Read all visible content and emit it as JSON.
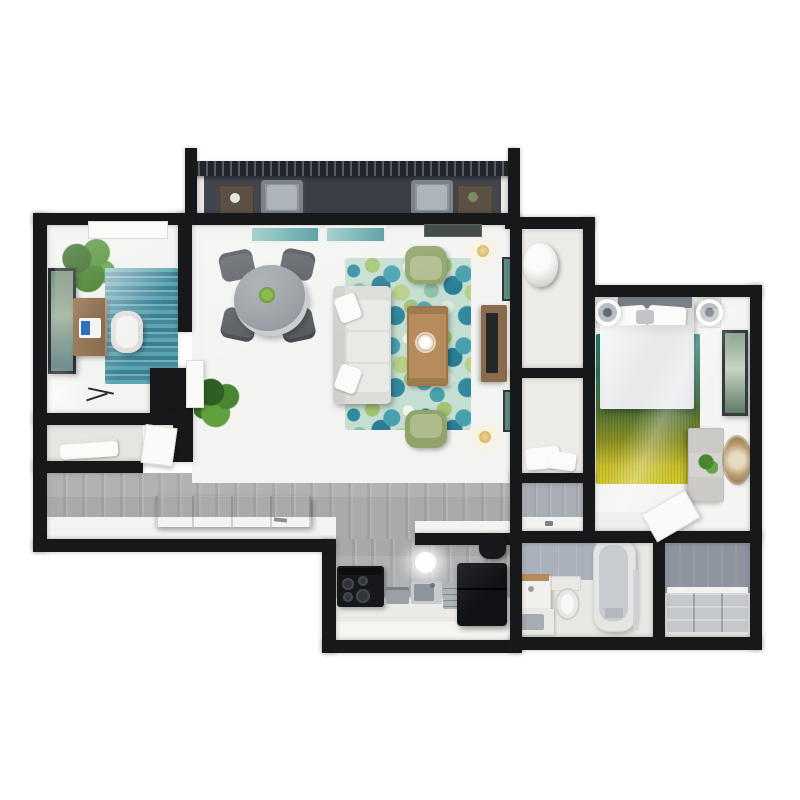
{
  "app": {
    "type": "3d-floor-plan-render",
    "view": "top-down",
    "visible_text": [],
    "background": "#ffffff"
  },
  "colors": {
    "wall": "#17181a",
    "wallface": "#f3f3f1",
    "wood": "#b3b5b7",
    "balcony": "#41464e",
    "balconydark": "#393e47",
    "railing": "#22252a",
    "closetfloor": "#99a1ad",
    "alcove": "#a9aeb4",
    "tile": "#aab1ba",
    "bathfloor": "#e9e7e3",
    "rugofficeB": "#3d7f92",
    "rugliving": "#c5ded2",
    "rugbedtop": "#237f71",
    "rugbedbot": "#d3c92e",
    "sofa": "#dcdcd8",
    "cushion": "#e9e9e5",
    "accentchair": "#90a369",
    "accentseat": "#aebc8b",
    "coffeetable": "#b78c5c",
    "consolewood": "#8a6b4c",
    "deskwood": "#8a6b4c",
    "diningchair": "#54585d",
    "diningtable": "#8f959b",
    "bench": "#c3b194",
    "counter": "#eceae6",
    "appliance": "#17181b",
    "fridge": "#101215",
    "sink": "#8f959c",
    "tubinner": "#c8ccd1",
    "duvet": "#e8e9eb",
    "headboard": "#7b818a",
    "dresser": "#d4d3d0",
    "mirror": "#c3a87e",
    "plantgreen": "#4a8531",
    "windowteal": "#5da3a5",
    "lampgold": "#caa75a"
  },
  "rooms": [
    {
      "id": "balcony",
      "label": "balcony",
      "furniture": [
        "railing",
        "patio-side-table-left",
        "patio-chair-left",
        "patio-chair-right",
        "patio-side-table-right"
      ]
    },
    {
      "id": "office-den",
      "label": "office / den",
      "furniture": [
        "skylight",
        "potted-plant",
        "wall-art",
        "desk",
        "laptop",
        "striped-area-rug",
        "desk-chair",
        "accent-ring-lamp-table"
      ]
    },
    {
      "id": "linen-closet",
      "label": "linen closet",
      "furniture": [
        "folded-linens",
        "open-door"
      ]
    },
    {
      "id": "living-dining",
      "label": "living / dining room",
      "furniture": [
        "window-left",
        "window-right",
        "ceiling-vent",
        "dining-table",
        "dining-chair-nw",
        "dining-chair-ne",
        "dining-chair-sw",
        "dining-chair-se",
        "sofa",
        "throw-pillows",
        "floral-area-rug",
        "accent-chair-top",
        "accent-chair-bottom",
        "coffee-table",
        "media-console",
        "tv",
        "wall-art-upper",
        "wall-art-lower",
        "floor-lamp-top",
        "floor-lamp-bottom",
        "floor-plant",
        "entry-bench",
        "office-open-door"
      ]
    },
    {
      "id": "hallway",
      "label": "hallway",
      "furniture": [
        "door-handle-mark",
        "bath-door-leaf"
      ]
    },
    {
      "id": "kitchen",
      "label": "kitchen",
      "furniture": [
        "range-cooktop",
        "toaster-oven",
        "kitchen-sink",
        "drawer-unit",
        "refrigerator",
        "ceiling-light",
        "range-hood"
      ]
    },
    {
      "id": "bathroom",
      "label": "bathroom",
      "furniture": [
        "vanity",
        "sink-counter",
        "toilet",
        "bathtub",
        "glass-screen",
        "tiled-wall"
      ]
    },
    {
      "id": "walk-in-closet",
      "label": "walk-in closet",
      "furniture": [
        "built-in-drawers",
        "clothes-rod-area"
      ]
    },
    {
      "id": "bedroom",
      "label": "bedroom",
      "furniture": [
        "bed",
        "headboard",
        "pillows",
        "nightstand-left",
        "nightstand-right",
        "table-lamp-left",
        "table-lamp-right",
        "gradient-rug",
        "wall-art",
        "dresser",
        "potted-plant-small",
        "decorative-mirror",
        "open-door"
      ]
    },
    {
      "id": "storage-closet-top",
      "label": "utility closet",
      "furniture": [
        "water-heater",
        "shelf"
      ]
    },
    {
      "id": "storage-closet-bottom",
      "label": "linen closet 2",
      "furniture": [
        "folded-linens",
        "shelf"
      ]
    }
  ]
}
